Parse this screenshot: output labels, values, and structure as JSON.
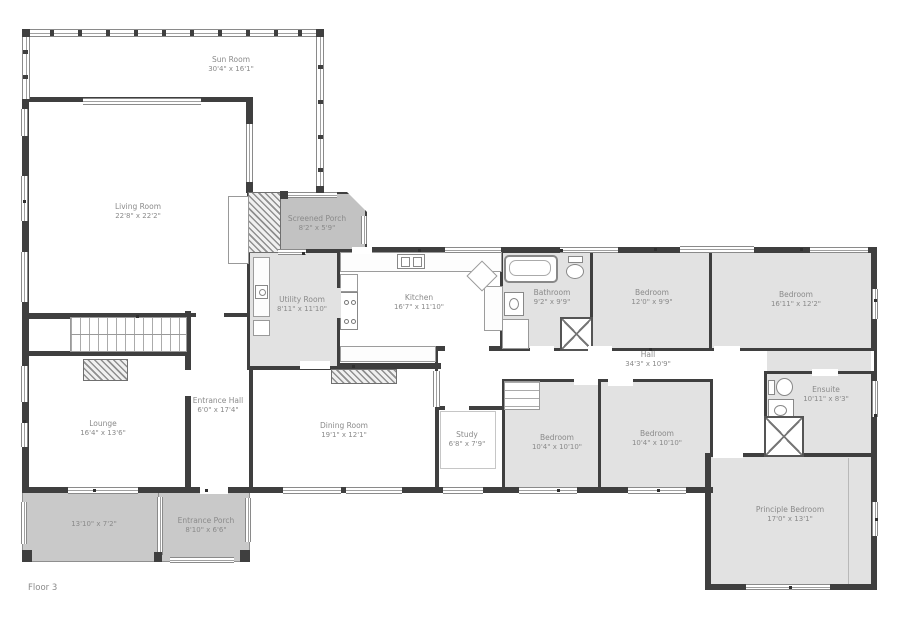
{
  "floor_label": "Floor 3",
  "colors": {
    "wall": "#3f3f3f",
    "room_gray": "#e2e2e2",
    "porch_gray": "#c9c9c9",
    "screen_porch_gray": "#c2c2c2",
    "label_text": "#8a8a8a"
  },
  "rooms": [
    {
      "id": "sun-room",
      "label": "Sun Room",
      "dims": "30'4\" x 16'1\"",
      "x": 22,
      "y": 29,
      "w": 302,
      "h": 163,
      "fill": "#ffffff",
      "bw": "0,0,0,0",
      "lx": 231,
      "ly": 55
    },
    {
      "id": "living-room",
      "label": "Living Room",
      "dims": "22'8\" x 22'2\"",
      "x": 22,
      "y": 97,
      "w": 231,
      "h": 221,
      "fill": "#ffffff",
      "bw": "5,5,5,5",
      "lx": 138,
      "ly": 202
    },
    {
      "id": "stairs-area",
      "label": "",
      "dims": "",
      "x": 22,
      "y": 315,
      "w": 168,
      "h": 42,
      "fill": "#ffffff",
      "bw": "4,0,0,4"
    },
    {
      "id": "lounge",
      "label": "Lounge",
      "dims": "16'4\" x 13'6\"",
      "x": 22,
      "y": 353,
      "w": 168,
      "h": 140,
      "fill": "#ffffff",
      "bw": "0,3,0,4",
      "lx": 103,
      "ly": 419
    },
    {
      "id": "entrance-hall",
      "label": "Entrance Hall",
      "dims": "6'0\" x 17'4\"",
      "x": 185,
      "y": 313,
      "w": 68,
      "h": 180,
      "fill": "#ffffff",
      "bw": "4,4,0,3",
      "lx": 218,
      "ly": 396
    },
    {
      "id": "dining-room",
      "label": "Dining Room",
      "dims": "19'1\" x 12'1\"",
      "x": 250,
      "y": 363,
      "w": 189,
      "h": 130,
      "fill": "#ffffff",
      "bw": "3,3,0,3",
      "lx": 344,
      "ly": 421
    },
    {
      "id": "porch",
      "label": "",
      "dims": "13'10\" x 7'2\"",
      "x": 22,
      "y": 490,
      "w": 141,
      "h": 72,
      "fill": "#c9c9c9",
      "thin": true,
      "lx": 94,
      "ly": 520
    },
    {
      "id": "entrance-porch",
      "label": "Entrance Porch",
      "dims": "8'10\" x 6'6\"",
      "x": 158,
      "y": 490,
      "w": 92,
      "h": 72,
      "fill": "#c9c9c9",
      "thin": true,
      "lx": 206,
      "ly": 516
    },
    {
      "id": "utility-room",
      "label": "Utility Room",
      "dims": "8'11\" x 11'10\"",
      "x": 247,
      "y": 250,
      "w": 93,
      "h": 120,
      "fill": "#e2e2e2",
      "bw": "3,3,4,3",
      "lx": 302,
      "ly": 295
    },
    {
      "id": "kitchen",
      "label": "Kitchen",
      "dims": "16'7\" x 11'10\"",
      "x": 337,
      "y": 247,
      "w": 168,
      "h": 105,
      "fill": "#ffffff",
      "bw": "4,3,0,3",
      "lx": 419,
      "ly": 293
    },
    {
      "id": "kitchen-lower",
      "label": "",
      "dims": "",
      "x": 337,
      "y": 348,
      "w": 104,
      "h": 21,
      "fill": "#ffffff",
      "bw": "0,0,0,3"
    },
    {
      "id": "screened-porch",
      "label": "Screened Porch",
      "dims": "8'2\" x 5'9\"",
      "x": 279,
      "y": 192,
      "w": 88,
      "h": 61,
      "fill": "#c2c2c2",
      "bw": "2,2,4,2",
      "bevel": true,
      "lx": 317,
      "ly": 214
    },
    {
      "id": "hall",
      "label": "Hall",
      "dims": "34'3\" x 10'9\"",
      "x": 435,
      "y": 346,
      "w": 442,
      "h": 66,
      "fill": "#ffffff",
      "bw": "5,3,3,3",
      "lx": 648,
      "ly": 350
    },
    {
      "id": "hall-east",
      "label": "",
      "dims": "",
      "x": 767,
      "y": 351,
      "w": 104,
      "h": 22,
      "fill": "#e2e2e2",
      "bw": "0,0,0,0"
    },
    {
      "id": "bathroom",
      "label": "Bathroom",
      "dims": "9'2\" x 9'9\"",
      "x": 500,
      "y": 250,
      "w": 93,
      "h": 101,
      "fill": "#e2e2e2",
      "bw": "3,3,3,3",
      "lx": 552,
      "ly": 288
    },
    {
      "id": "bedroom-1",
      "label": "Bedroom",
      "dims": "12'0\" x 9'9\"",
      "x": 590,
      "y": 250,
      "w": 122,
      "h": 101,
      "fill": "#e2e2e2",
      "bw": "3,3,3,3",
      "lx": 652,
      "ly": 288
    },
    {
      "id": "bedroom-2",
      "label": "Bedroom",
      "dims": "16'11\" x 12'2\"",
      "x": 709,
      "y": 250,
      "w": 168,
      "h": 101,
      "fill": "#e2e2e2",
      "bw": "3,3,3,3",
      "lx": 796,
      "ly": 290
    },
    {
      "id": "hall-link",
      "label": "",
      "dims": "",
      "x": 710,
      "y": 406,
      "w": 57,
      "h": 53,
      "fill": "#ffffff",
      "bw": "0,3,0,3"
    },
    {
      "id": "study",
      "label": "Study",
      "dims": "6'8\" x 7'9\"",
      "x": 435,
      "y": 406,
      "w": 70,
      "h": 87,
      "fill": "#ffffff",
      "bw": "4,3,0,4",
      "lx": 467,
      "ly": 430
    },
    {
      "id": "bedroom-3",
      "label": "Bedroom",
      "dims": "10'4\" x 10'10\"",
      "x": 502,
      "y": 379,
      "w": 99,
      "h": 114,
      "fill": "#e2e2e2",
      "bw": "3,3,0,3",
      "lx": 557,
      "ly": 433
    },
    {
      "id": "bedroom-4",
      "label": "Bedroom",
      "dims": "10'4\" x 10'10\"",
      "x": 598,
      "y": 379,
      "w": 115,
      "h": 114,
      "fill": "#e2e2e2",
      "bw": "3,3,0,3",
      "lx": 657,
      "ly": 429
    },
    {
      "id": "ensuite",
      "label": "Ensuite",
      "dims": "10'11\" x 8'3\"",
      "x": 764,
      "y": 371,
      "w": 113,
      "h": 88,
      "fill": "#e2e2e2",
      "bw": "3,0,3,3",
      "lx": 826,
      "ly": 385
    },
    {
      "id": "principle-bedroom",
      "label": "Principle Bedroom",
      "dims": "17'0\" x 13'1\"",
      "x": 705,
      "y": 453,
      "w": 172,
      "h": 137,
      "fill": "#e2e2e2",
      "bw": "4,0,0,0",
      "lx": 790,
      "ly": 505
    }
  ],
  "walls": [
    {
      "x": 22,
      "y": 487,
      "w": 691,
      "h": 6
    },
    {
      "x": 367,
      "y": 247,
      "w": 510,
      "h": 6
    },
    {
      "x": 871,
      "y": 247,
      "w": 6,
      "h": 104
    },
    {
      "x": 871,
      "y": 371,
      "w": 6,
      "h": 219
    },
    {
      "x": 705,
      "y": 584,
      "w": 172,
      "h": 6
    },
    {
      "x": 705,
      "y": 453,
      "w": 6,
      "h": 137
    },
    {
      "x": 22,
      "y": 97,
      "w": 7,
      "h": 396
    },
    {
      "x": 246,
      "y": 97,
      "w": 7,
      "h": 96
    },
    {
      "x": 247,
      "y": 188,
      "w": 6,
      "h": 64
    },
    {
      "x": 185,
      "y": 311,
      "w": 6,
      "h": 182
    },
    {
      "x": 22,
      "y": 351,
      "w": 168,
      "h": 5
    },
    {
      "x": 337,
      "y": 363,
      "w": 104,
      "h": 6
    }
  ],
  "windows": [
    {
      "x": 83,
      "y": 98,
      "w": 118,
      "h": 7,
      "o": "h"
    },
    {
      "x": 21,
      "y": 109,
      "w": 7,
      "h": 27,
      "o": "v"
    },
    {
      "x": 21,
      "y": 176,
      "w": 7,
      "h": 45,
      "o": "v"
    },
    {
      "x": 21,
      "y": 252,
      "w": 7,
      "h": 50,
      "o": "v"
    },
    {
      "x": 246,
      "y": 124,
      "w": 7,
      "h": 58,
      "o": "v"
    },
    {
      "x": 21,
      "y": 366,
      "w": 7,
      "h": 36,
      "o": "v"
    },
    {
      "x": 21,
      "y": 423,
      "w": 7,
      "h": 24,
      "o": "v"
    },
    {
      "x": 68,
      "y": 487,
      "w": 70,
      "h": 7,
      "o": "h"
    },
    {
      "x": 278,
      "y": 249,
      "w": 28,
      "h": 6,
      "o": "h"
    },
    {
      "x": 445,
      "y": 247,
      "w": 56,
      "h": 6,
      "o": "h"
    },
    {
      "x": 560,
      "y": 247,
      "w": 58,
      "h": 6,
      "o": "h"
    },
    {
      "x": 680,
      "y": 246,
      "w": 74,
      "h": 7,
      "o": "h"
    },
    {
      "x": 810,
      "y": 247,
      "w": 58,
      "h": 6,
      "o": "h"
    },
    {
      "x": 872,
      "y": 289,
      "w": 6,
      "h": 30,
      "o": "v"
    },
    {
      "x": 872,
      "y": 381,
      "w": 6,
      "h": 36,
      "o": "v"
    },
    {
      "x": 872,
      "y": 502,
      "w": 6,
      "h": 34,
      "o": "v"
    },
    {
      "x": 746,
      "y": 584,
      "w": 84,
      "h": 6,
      "o": "h"
    },
    {
      "x": 519,
      "y": 487,
      "w": 58,
      "h": 7,
      "o": "h"
    },
    {
      "x": 628,
      "y": 487,
      "w": 58,
      "h": 7,
      "o": "h"
    },
    {
      "x": 283,
      "y": 487,
      "w": 58,
      "h": 7,
      "o": "h"
    },
    {
      "x": 346,
      "y": 487,
      "w": 56,
      "h": 7,
      "o": "h"
    },
    {
      "x": 443,
      "y": 487,
      "w": 40,
      "h": 7,
      "o": "h"
    },
    {
      "x": 433,
      "y": 371,
      "w": 7,
      "h": 36,
      "o": "v"
    },
    {
      "x": 22,
      "y": 29,
      "w": 302,
      "h": 8,
      "o": "h"
    },
    {
      "x": 316,
      "y": 29,
      "w": 8,
      "h": 164,
      "o": "v"
    },
    {
      "x": 22,
      "y": 29,
      "w": 8,
      "h": 70,
      "o": "v"
    },
    {
      "x": 21,
      "y": 502,
      "w": 6,
      "h": 42,
      "o": "v"
    },
    {
      "x": 157,
      "y": 497,
      "w": 6,
      "h": 58,
      "o": "v"
    },
    {
      "x": 245,
      "y": 498,
      "w": 6,
      "h": 44,
      "o": "v"
    },
    {
      "x": 170,
      "y": 557,
      "w": 64,
      "h": 6,
      "o": "h"
    },
    {
      "x": 287,
      "y": 192,
      "w": 50,
      "h": 6,
      "o": "h"
    },
    {
      "x": 361,
      "y": 216,
      "w": 6,
      "h": 28,
      "o": "v"
    }
  ],
  "doors": [
    {
      "x": 530,
      "y": 346,
      "w": 24,
      "h": 8
    },
    {
      "x": 588,
      "y": 346,
      "w": 24,
      "h": 8
    },
    {
      "x": 714,
      "y": 346,
      "w": 26,
      "h": 8
    },
    {
      "x": 812,
      "y": 369,
      "w": 26,
      "h": 7
    },
    {
      "x": 574,
      "y": 378,
      "w": 24,
      "h": 7
    },
    {
      "x": 608,
      "y": 379,
      "w": 25,
      "h": 7
    },
    {
      "x": 445,
      "y": 404,
      "w": 24,
      "h": 7
    },
    {
      "x": 713,
      "y": 450,
      "w": 30,
      "h": 8
    },
    {
      "x": 300,
      "y": 361,
      "w": 30,
      "h": 8
    },
    {
      "x": 196,
      "y": 311,
      "w": 28,
      "h": 8
    },
    {
      "x": 200,
      "y": 486,
      "w": 28,
      "h": 8
    },
    {
      "x": 184,
      "y": 370,
      "w": 8,
      "h": 26
    },
    {
      "x": 352,
      "y": 247,
      "w": 20,
      "h": 7
    },
    {
      "x": 334,
      "y": 288,
      "w": 7,
      "h": 30,
      "c": "#e2e2e2"
    },
    {
      "x": 445,
      "y": 344,
      "w": 44,
      "h": 8
    }
  ],
  "posts": [
    {
      "x": 22,
      "y": 29,
      "w": 8,
      "h": 8
    },
    {
      "x": 316,
      "y": 29,
      "w": 8,
      "h": 8
    },
    {
      "x": 316,
      "y": 186,
      "w": 8,
      "h": 7
    },
    {
      "x": 280,
      "y": 191,
      "w": 8,
      "h": 8
    },
    {
      "x": 50,
      "y": 30,
      "w": 4,
      "h": 6
    },
    {
      "x": 78,
      "y": 30,
      "w": 4,
      "h": 6
    },
    {
      "x": 106,
      "y": 30,
      "w": 4,
      "h": 6
    },
    {
      "x": 134,
      "y": 30,
      "w": 4,
      "h": 6
    },
    {
      "x": 162,
      "y": 30,
      "w": 4,
      "h": 6
    },
    {
      "x": 190,
      "y": 30,
      "w": 4,
      "h": 6
    },
    {
      "x": 218,
      "y": 30,
      "w": 4,
      "h": 6
    },
    {
      "x": 246,
      "y": 30,
      "w": 4,
      "h": 6
    },
    {
      "x": 274,
      "y": 30,
      "w": 4,
      "h": 6
    },
    {
      "x": 298,
      "y": 30,
      "w": 4,
      "h": 6
    },
    {
      "x": 318,
      "y": 65,
      "w": 5,
      "h": 4
    },
    {
      "x": 318,
      "y": 100,
      "w": 5,
      "h": 4
    },
    {
      "x": 318,
      "y": 135,
      "w": 5,
      "h": 4
    },
    {
      "x": 318,
      "y": 168,
      "w": 5,
      "h": 4
    },
    {
      "x": 23,
      "y": 50,
      "w": 5,
      "h": 4
    },
    {
      "x": 23,
      "y": 75,
      "w": 5,
      "h": 4
    },
    {
      "x": 22,
      "y": 550,
      "w": 10,
      "h": 12
    },
    {
      "x": 240,
      "y": 550,
      "w": 10,
      "h": 12
    },
    {
      "x": 154,
      "y": 552,
      "w": 8,
      "h": 10
    }
  ],
  "ticks": [
    {
      "x": 136,
      "y": 315
    },
    {
      "x": 560,
      "y": 249
    },
    {
      "x": 654,
      "y": 248
    },
    {
      "x": 800,
      "y": 248
    },
    {
      "x": 874,
      "y": 299
    },
    {
      "x": 874,
      "y": 414
    },
    {
      "x": 557,
      "y": 489
    },
    {
      "x": 657,
      "y": 489
    },
    {
      "x": 789,
      "y": 586
    },
    {
      "x": 93,
      "y": 489
    },
    {
      "x": 205,
      "y": 489
    },
    {
      "x": 23,
      "y": 200
    },
    {
      "x": 23,
      "y": 420
    },
    {
      "x": 352,
      "y": 365
    },
    {
      "x": 302,
      "y": 252
    },
    {
      "x": 649,
      "y": 348
    },
    {
      "x": 875,
      "y": 518
    },
    {
      "x": 418,
      "y": 249
    }
  ],
  "furniture": [
    {
      "t": "stairs",
      "x": 70,
      "y": 317,
      "w": 117,
      "h": 35
    },
    {
      "t": "hatch",
      "x": 248,
      "y": 192,
      "w": 33,
      "h": 61
    },
    {
      "t": "box",
      "x": 228,
      "y": 196,
      "w": 21,
      "h": 68
    },
    {
      "t": "hatch",
      "x": 83,
      "y": 359,
      "w": 45,
      "h": 22
    },
    {
      "t": "hatch",
      "x": 331,
      "y": 369,
      "w": 66,
      "h": 15
    },
    {
      "t": "counter",
      "x": 340,
      "y": 252,
      "w": 162,
      "h": 20
    },
    {
      "t": "sink2",
      "x": 397,
      "y": 254,
      "w": 28,
      "h": 15
    },
    {
      "t": "counter",
      "x": 484,
      "y": 286,
      "w": 19,
      "h": 45
    },
    {
      "t": "counter",
      "x": 340,
      "y": 346,
      "w": 96,
      "h": 16
    },
    {
      "t": "island",
      "x": 471,
      "y": 265,
      "w": 22,
      "h": 22
    },
    {
      "t": "box",
      "x": 340,
      "y": 274,
      "w": 18,
      "h": 18
    },
    {
      "t": "stove",
      "x": 340,
      "y": 292,
      "w": 18,
      "h": 38
    },
    {
      "t": "counter",
      "x": 253,
      "y": 257,
      "w": 17,
      "h": 60
    },
    {
      "t": "sink",
      "x": 255,
      "y": 285,
      "w": 13,
      "h": 14
    },
    {
      "t": "box",
      "x": 253,
      "y": 320,
      "w": 17,
      "h": 16
    },
    {
      "t": "tub",
      "x": 504,
      "y": 255,
      "w": 54,
      "h": 28
    },
    {
      "t": "toilet-v",
      "x": 565,
      "y": 256,
      "w": 21,
      "h": 24
    },
    {
      "t": "sink",
      "x": 504,
      "y": 292,
      "w": 20,
      "h": 24
    },
    {
      "t": "shower",
      "x": 560,
      "y": 317,
      "w": 33,
      "h": 34
    },
    {
      "t": "box",
      "x": 502,
      "y": 319,
      "w": 27,
      "h": 30
    },
    {
      "t": "toilet-h",
      "x": 768,
      "y": 377,
      "w": 26,
      "h": 21
    },
    {
      "t": "sink",
      "x": 768,
      "y": 399,
      "w": 26,
      "h": 21
    },
    {
      "t": "shower",
      "x": 764,
      "y": 416,
      "w": 40,
      "h": 41
    },
    {
      "t": "desk",
      "x": 440,
      "y": 411,
      "w": 56,
      "h": 58
    },
    {
      "t": "shelf",
      "x": 504,
      "y": 381,
      "w": 36,
      "h": 29
    },
    {
      "t": "line",
      "x": 848,
      "y": 458,
      "w": 1,
      "h": 126
    }
  ]
}
